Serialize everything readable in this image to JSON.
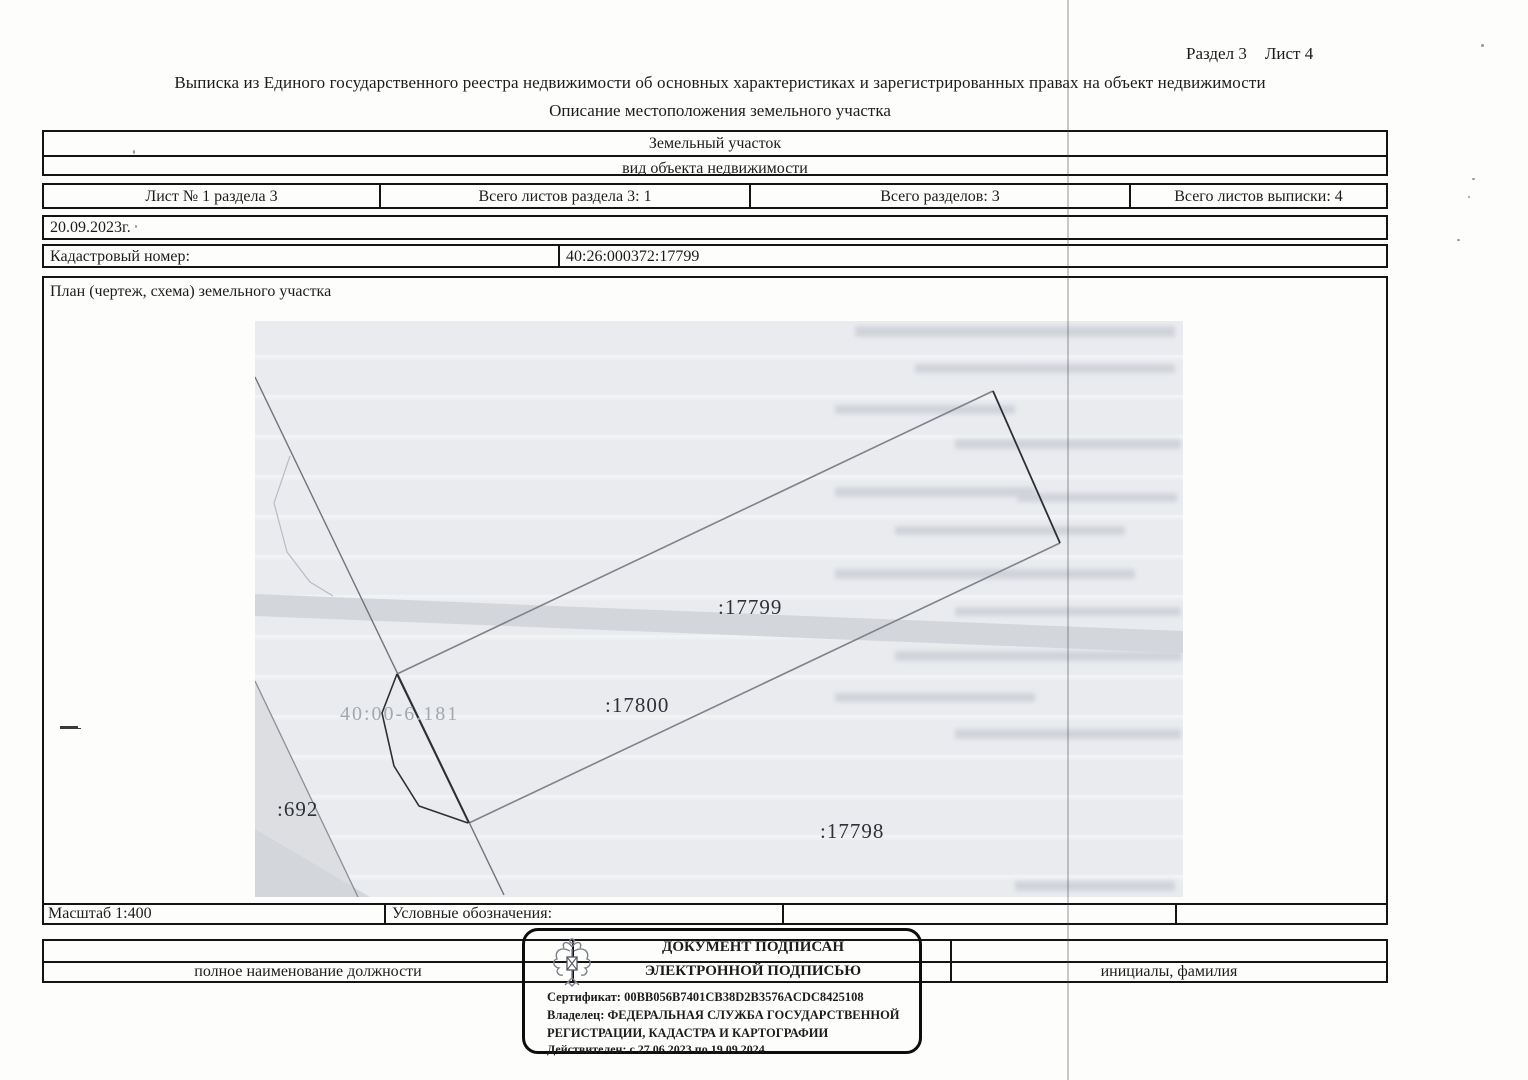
{
  "header": {
    "section": "Раздел 3",
    "sheet": "Лист 4",
    "title": "Выписка из Единого государственного реестра недвижимости об основных характеристиках и зарегистрированных правах на объект недвижимости",
    "subtitle": "Описание местоположения земельного участка"
  },
  "object_box": {
    "name": "Земельный участок",
    "kind_label": "вид объекта недвижимости"
  },
  "sheets_row": {
    "cells": [
      "Лист № 1 раздела 3",
      "Всего листов раздела 3: 1",
      "Всего разделов: 3",
      "Всего листов выписки: 4"
    ]
  },
  "date": "20.09.2023г.",
  "cadastral": {
    "label": "Кадастровый номер:",
    "value": "40:26:000372:17799"
  },
  "plan": {
    "title": "План (чертеж, схема) земельного участка",
    "scale": "Масштаб 1:400",
    "legend_label": "Условные обозначения:",
    "labels": {
      "parcel_17800": ":17800",
      "parcel_17799": ":17799",
      "parcel_17798": ":17798",
      "parcel_692": ":692",
      "zone": "40:00-6.181"
    }
  },
  "signature": {
    "position_label": "полное наименование должности",
    "initials_label": "инициалы, фамилия",
    "stamp": {
      "line1": "ДОКУМЕНТ ПОДПИСАН",
      "line2": "ЭЛЕКТРОННОЙ ПОДПИСЬЮ",
      "certificate": "Сертификат: 00BB056B7401CB38D2B3576ACDC8425108",
      "owner_line1": "Владелец: ФЕДЕРАЛЬНАЯ СЛУЖБА ГОСУДАРСТВЕННОЙ",
      "owner_line2": "РЕГИСТРАЦИИ, КАДАСТРА И КАРТОГРАФИИ",
      "validity": "Действителен: с 27.06.2023 по 19.09.2024"
    }
  },
  "colors": {
    "map_bg": "#e9ebef",
    "map_band": "#d3d6db",
    "parcel_line_dark": "#2b2e33",
    "parcel_line_grey": "#7e8288"
  }
}
